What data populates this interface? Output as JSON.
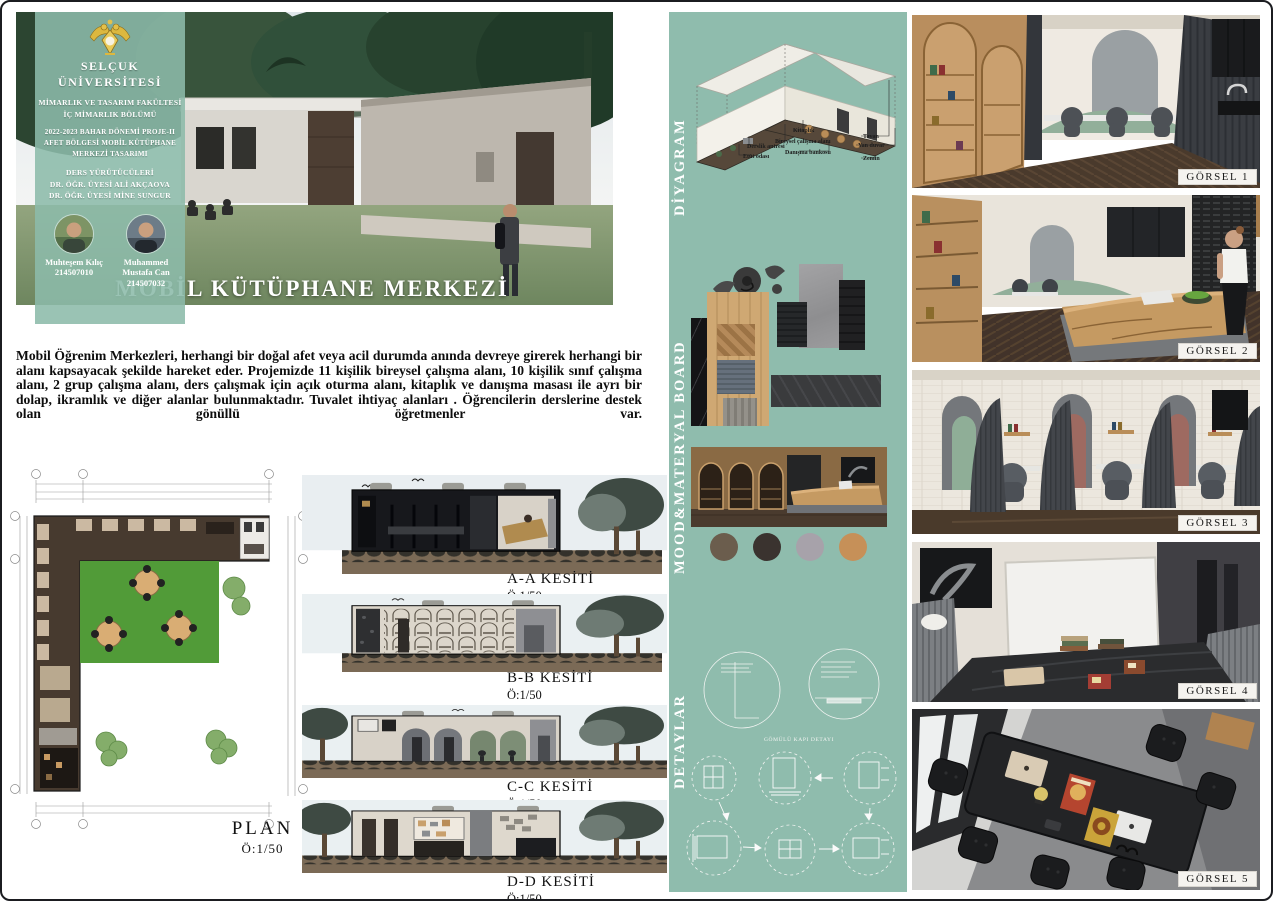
{
  "board": {
    "title": "MOBİL KÜTÜPHANE MERKEZİ"
  },
  "sidebar": {
    "university": "SELÇUK ÜNİVERSİTESİ",
    "faculty_line1": "MİMARLIK VE TASARIM FAKÜLTESİ",
    "faculty_line2": "İÇ MİMARLIK BÖLÜMÜ",
    "project_line1": "2022-2023 BAHAR DÖNEMİ PROJE-II",
    "project_line2": "AFET BÖLGESİ MOBİL KÜTÜPHANE",
    "project_line3": "MERKEZİ TASARIMI",
    "lecturers_heading": "DERS YÜRÜTÜCÜLERİ",
    "lecturer1": "DR. ÖĞR. ÜYESİ ALİ AKÇAOVA",
    "lecturer2": "DR. ÖĞR. ÜYESİ MİNE SUNGUR",
    "students": [
      {
        "name": "Muhteşem Kılıç",
        "id": "214507010"
      },
      {
        "name": "Muhammed Mustafa Can",
        "id": "214507032"
      }
    ]
  },
  "intro": {
    "text": "Mobil Öğrenim Merkezleri, herhangi bir doğal afet veya acil durumda anında devreye girerek herhangi bir alanı kapsayacak şekilde hareket eder. Projemizde 11 kişilik bireysel çalışma alanı, 10 kişilik sınıf çalışma alanı, 2 grup çalışma alanı, ders çalışmak için açık oturma alanı, kitaplık ve danışma masası ile ayrı bir dolap, ikramlık ve diğer alanlar bulunmaktadır. Tuvalet ihtiyaç alanları . Öğrencilerin derslerine destek olan gönüllü öğretmenler var."
  },
  "plan": {
    "label": "PLAN",
    "scale": "Ö:1/50"
  },
  "sections": [
    {
      "label": "A-A KESİTİ",
      "scale": "Ö:1/50"
    },
    {
      "label": "B-B KESİTİ",
      "scale": "Ö:1/50"
    },
    {
      "label": "C-C KESİTİ",
      "scale": "Ö:1/50"
    },
    {
      "label": "D-D KESİTİ",
      "scale": "Ö:1/50"
    }
  ],
  "strip": {
    "diagram_label": "DİYAGRAM",
    "moodboard_label": "MOOD&MATERYAL BOARD",
    "details_label": "DETAYLAR",
    "diagram": {
      "ann_left1": "Derslik antresi",
      "ann_left2": "Etüt odası",
      "ann_mid1": "Kitaplık",
      "ann_mid2": "Bireysel çalışma alanı",
      "ann_mid3": "Danışma bankosu",
      "ann_right1": "Tavan",
      "ann_right2": "Yan duvar",
      "ann_right3": "Zemin"
    },
    "detail_caption": "GÖMÜLÜ KAPI DETAYI",
    "swatches": [
      "#6b5d4d",
      "#3a332f",
      "#a7a2aa",
      "#c69058"
    ]
  },
  "gallery": [
    {
      "label": "GÖRSEL 1"
    },
    {
      "label": "GÖRSEL 2"
    },
    {
      "label": "GÖRSEL 3"
    },
    {
      "label": "GÖRSEL 4"
    },
    {
      "label": "GÖRSEL 5"
    }
  ],
  "colors": {
    "strip_green": "#8fbcad",
    "sidebar_green": "#8cbbaa"
  }
}
